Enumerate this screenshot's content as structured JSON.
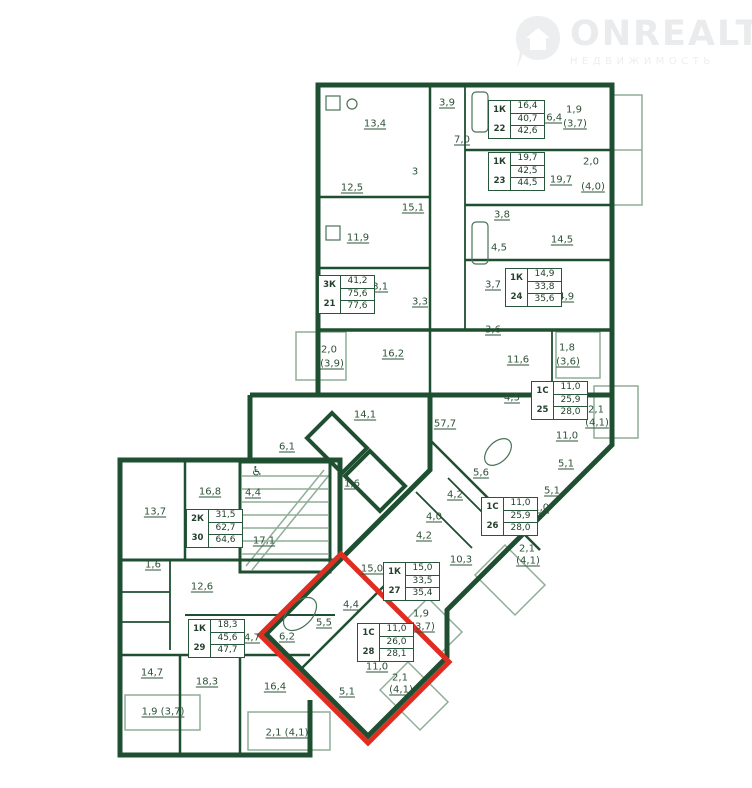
{
  "watermark": {
    "brand": "ONREALT",
    "subtitle": "НЕДВИЖИМОСТЬ",
    "icon": "house-pin-icon"
  },
  "icons": {
    "wheelchair": "♿"
  },
  "colors": {
    "wall": "#1f4f31",
    "label": "#2c5237",
    "highlight": "#e02d22",
    "watermark": "#e9ebec",
    "balcony_line": "#8fae97"
  },
  "highlight": {
    "apartment": "28",
    "shape": "rotated-rect",
    "points": "341,554 449,662 368,743 260,635"
  },
  "apartments": [
    {
      "number": "21",
      "type": "3К",
      "values": [
        "41,2",
        "75,6",
        "77,6"
      ],
      "x": 318,
      "y": 275
    },
    {
      "number": "22",
      "type": "1К",
      "values": [
        "16,4",
        "40,7",
        "42,6"
      ],
      "x": 488,
      "y": 100
    },
    {
      "number": "23",
      "type": "1К",
      "values": [
        "19,7",
        "42,5",
        "44,5"
      ],
      "x": 488,
      "y": 152
    },
    {
      "number": "24",
      "type": "1К",
      "values": [
        "14,9",
        "33,8",
        "35,6"
      ],
      "x": 505,
      "y": 268
    },
    {
      "number": "25",
      "type": "1С",
      "values": [
        "11,0",
        "25,9",
        "28,0"
      ],
      "x": 531,
      "y": 381
    },
    {
      "number": "26",
      "type": "1С",
      "values": [
        "11,0",
        "25,9",
        "28,0"
      ],
      "x": 481,
      "y": 497
    },
    {
      "number": "27",
      "type": "1К",
      "values": [
        "15,0",
        "33,5",
        "35,4"
      ],
      "x": 383,
      "y": 562
    },
    {
      "number": "28",
      "type": "1С",
      "values": [
        "11,0",
        "26,0",
        "28,1"
      ],
      "x": 357,
      "y": 623
    },
    {
      "number": "29",
      "type": "1К",
      "values": [
        "18,3",
        "45,6",
        "47,7"
      ],
      "x": 188,
      "y": 619
    },
    {
      "number": "30",
      "type": "2К",
      "values": [
        "31,5",
        "62,7",
        "64,6"
      ],
      "x": 186,
      "y": 509
    }
  ],
  "labels": [
    {
      "text": "13,4",
      "x": 375,
      "y": 124,
      "u": true
    },
    {
      "text": "3,9",
      "x": 447,
      "y": 103,
      "u": true
    },
    {
      "text": "7,0",
      "x": 462,
      "y": 140,
      "u": true
    },
    {
      "text": "3",
      "x": 415,
      "y": 172,
      "u": false
    },
    {
      "text": "12,5",
      "x": 352,
      "y": 188,
      "u": true
    },
    {
      "text": "15,1",
      "x": 413,
      "y": 208,
      "u": true
    },
    {
      "text": "11,9",
      "x": 358,
      "y": 238,
      "u": true
    },
    {
      "text": "13,1",
      "x": 377,
      "y": 287,
      "u": true
    },
    {
      "text": "3,3",
      "x": 420,
      "y": 302,
      "u": true
    },
    {
      "text": "2,0",
      "x": 329,
      "y": 350,
      "u": false
    },
    {
      "text": "(3,9)",
      "x": 332,
      "y": 364,
      "u": true
    },
    {
      "text": "16,2",
      "x": 393,
      "y": 354,
      "u": true
    },
    {
      "text": "16,4",
      "x": 551,
      "y": 118,
      "u": true
    },
    {
      "text": "1,9",
      "x": 574,
      "y": 110,
      "u": false
    },
    {
      "text": "(3,7)",
      "x": 575,
      "y": 124,
      "u": true
    },
    {
      "text": "19,7",
      "x": 561,
      "y": 180,
      "u": true
    },
    {
      "text": "2,0",
      "x": 591,
      "y": 162,
      "u": false
    },
    {
      "text": "(4,0)",
      "x": 593,
      "y": 187,
      "u": true
    },
    {
      "text": "3,8",
      "x": 502,
      "y": 215,
      "u": true
    },
    {
      "text": "14,5",
      "x": 562,
      "y": 240,
      "u": true
    },
    {
      "text": "4,5",
      "x": 499,
      "y": 248,
      "u": false
    },
    {
      "text": "3,7",
      "x": 493,
      "y": 285,
      "u": true
    },
    {
      "text": "14,9",
      "x": 563,
      "y": 297,
      "u": true
    },
    {
      "text": "3,6",
      "x": 493,
      "y": 330,
      "u": true
    },
    {
      "text": "11,6",
      "x": 518,
      "y": 360,
      "u": true
    },
    {
      "text": "1,8",
      "x": 567,
      "y": 348,
      "u": false
    },
    {
      "text": "(3,6)",
      "x": 568,
      "y": 362,
      "u": true
    },
    {
      "text": "4,5",
      "x": 512,
      "y": 398,
      "u": true
    },
    {
      "text": "2,1",
      "x": 596,
      "y": 410,
      "u": false
    },
    {
      "text": "(4,1)",
      "x": 597,
      "y": 423,
      "u": true
    },
    {
      "text": "11,0",
      "x": 567,
      "y": 436,
      "u": true
    },
    {
      "text": "57,7",
      "x": 445,
      "y": 424,
      "u": true
    },
    {
      "text": "14,1",
      "x": 365,
      "y": 415,
      "u": true
    },
    {
      "text": "6,1",
      "x": 287,
      "y": 447,
      "u": true
    },
    {
      "text": "1,6",
      "x": 352,
      "y": 484,
      "u": true
    },
    {
      "text": "5,6",
      "x": 481,
      "y": 473,
      "u": true
    },
    {
      "text": "5,1",
      "x": 566,
      "y": 464,
      "u": true
    },
    {
      "text": "5,1",
      "x": 552,
      "y": 491,
      "u": true
    },
    {
      "text": "4,2",
      "x": 455,
      "y": 495,
      "u": true
    },
    {
      "text": "4,0",
      "x": 434,
      "y": 517,
      "u": true
    },
    {
      "text": "4,2",
      "x": 424,
      "y": 536,
      "u": true
    },
    {
      "text": "11,0",
      "x": 538,
      "y": 508,
      "u": true
    },
    {
      "text": "2,1",
      "x": 527,
      "y": 549,
      "u": false
    },
    {
      "text": "(4,1)",
      "x": 528,
      "y": 561,
      "u": true
    },
    {
      "text": "10,3",
      "x": 461,
      "y": 560,
      "u": true
    },
    {
      "text": "15,0",
      "x": 372,
      "y": 569,
      "u": true
    },
    {
      "text": "1,9",
      "x": 421,
      "y": 614,
      "u": false
    },
    {
      "text": "(3,7)",
      "x": 423,
      "y": 627,
      "u": true
    },
    {
      "text": "4,4",
      "x": 351,
      "y": 605,
      "u": true
    },
    {
      "text": "5,5",
      "x": 324,
      "y": 623,
      "u": true
    },
    {
      "text": "6,2",
      "x": 287,
      "y": 637,
      "u": true
    },
    {
      "text": "4,7",
      "x": 252,
      "y": 638,
      "u": true
    },
    {
      "text": "11,0",
      "x": 377,
      "y": 667,
      "u": true
    },
    {
      "text": "2,1",
      "x": 400,
      "y": 678,
      "u": false
    },
    {
      "text": "(4,1)",
      "x": 401,
      "y": 690,
      "u": true
    },
    {
      "text": "5,1",
      "x": 347,
      "y": 692,
      "u": true
    },
    {
      "text": "16,8",
      "x": 210,
      "y": 492,
      "u": true
    },
    {
      "text": "4,4",
      "x": 253,
      "y": 493,
      "u": true
    },
    {
      "text": "13,7",
      "x": 155,
      "y": 512,
      "u": true
    },
    {
      "text": "17,1",
      "x": 264,
      "y": 541,
      "u": true
    },
    {
      "text": "1,6",
      "x": 153,
      "y": 565,
      "u": true
    },
    {
      "text": "12,6",
      "x": 202,
      "y": 587,
      "u": true
    },
    {
      "text": "14,7",
      "x": 152,
      "y": 673,
      "u": true
    },
    {
      "text": "18,3",
      "x": 207,
      "y": 682,
      "u": true
    },
    {
      "text": "16,4",
      "x": 275,
      "y": 687,
      "u": true
    },
    {
      "text": "1,9 (3,7)",
      "x": 163,
      "y": 712,
      "u": true
    },
    {
      "text": "2,1 (4,1)",
      "x": 287,
      "y": 733,
      "u": true
    }
  ]
}
